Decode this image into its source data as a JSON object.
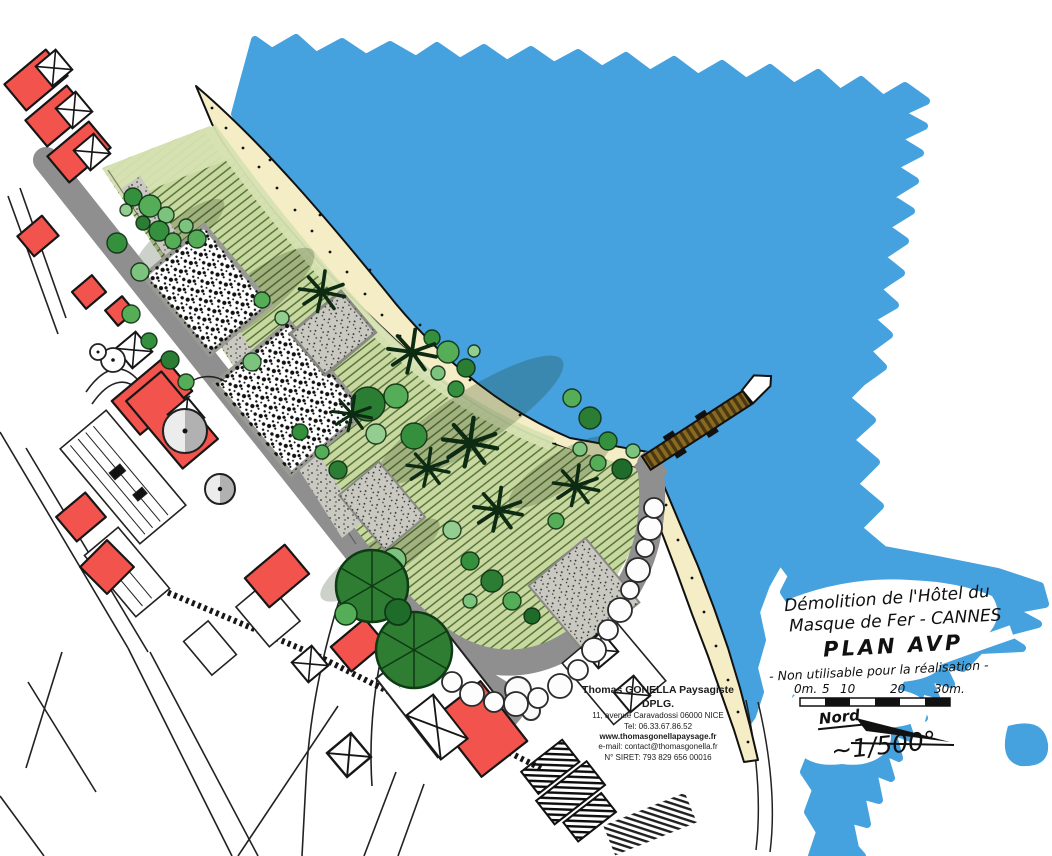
{
  "meta": {
    "kind": "hand-drawn landscape site plan"
  },
  "colors": {
    "water": "#45A2DF",
    "beach": "#F4EDC5",
    "lawn": "#C9D7A0",
    "lawn_hatch": "#3A6220",
    "road": "#8F8F8F",
    "building_red": "#F2534D",
    "tree_green": "#35903E",
    "canopy_dark": "#2E7D32",
    "pier_brown": "#8A6A22",
    "ink": "#161616"
  },
  "title_block": {
    "line1": "Démolition de l'Hôtel du",
    "line2": "Masque de Fer - CANNES",
    "line3": "PLAN AVP",
    "line4": "- Non utilisable pour la réalisation -"
  },
  "scale_bar": {
    "labels": [
      "0m.",
      "5",
      "10",
      "20",
      "30m."
    ]
  },
  "north_label": "Nord",
  "scale_ratio": "~1/500°",
  "firm": {
    "name": "Thomas GONELLA Paysagiste DPLG.",
    "address": "11, avenue Caravadossi 06000 NICE",
    "tel": "Tel: 06.33.67.86.52",
    "website": "www.thomasgonellapaysage.fr",
    "email": "e-mail: contact@thomasgonella.fr",
    "siret": "N° SIRET: 793 829 656 00016"
  }
}
